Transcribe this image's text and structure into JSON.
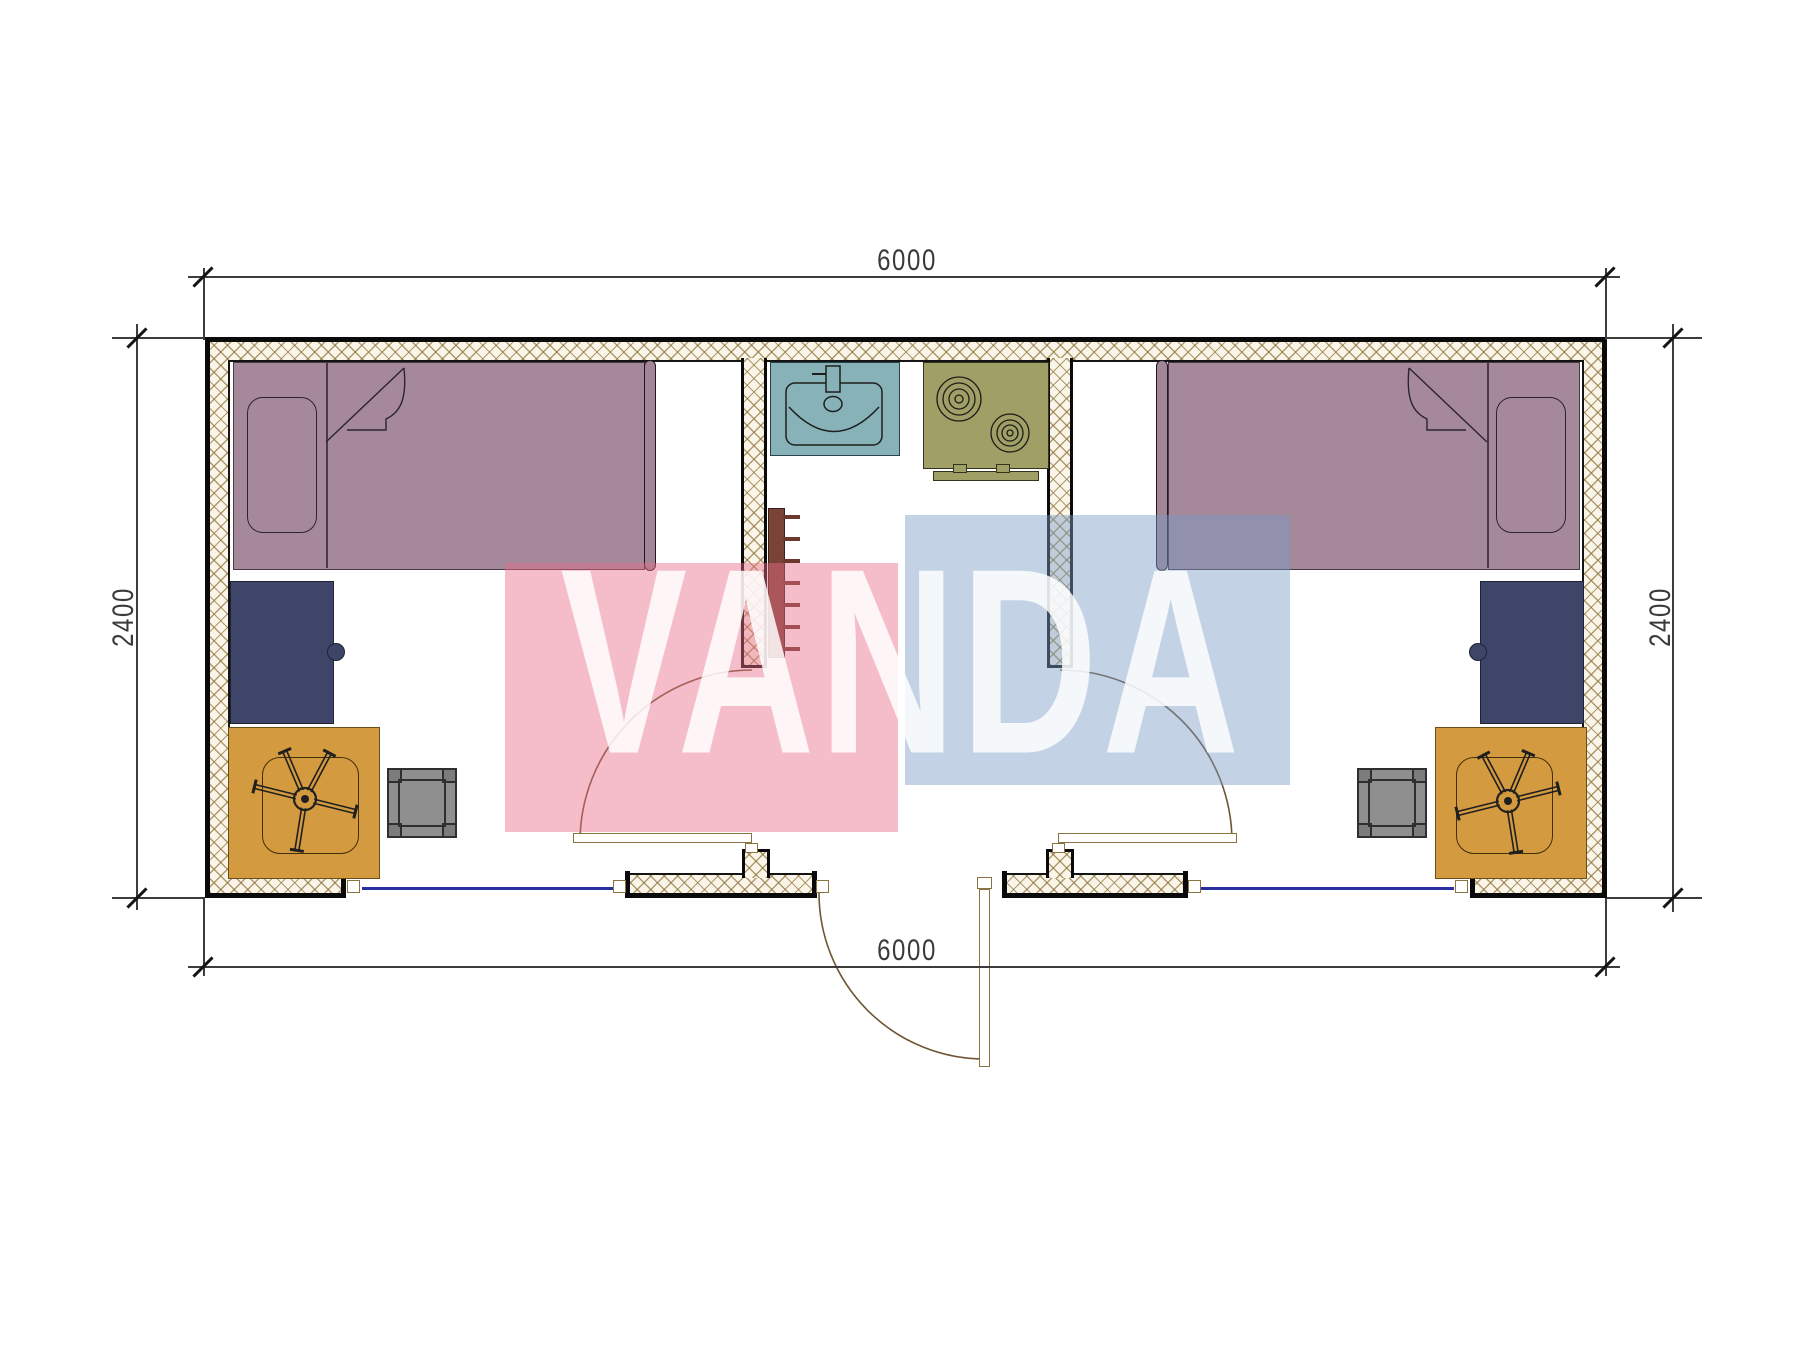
{
  "plan": {
    "type": "floor-plan",
    "overall_width_mm": "6000",
    "overall_depth_mm": "2400",
    "dimensions": {
      "top": "6000",
      "bottom": "6000",
      "left": "2400",
      "right": "2400"
    },
    "watermark": {
      "text": "VANDA",
      "pink_block": "#e96c87",
      "blue_block": "#7a9bc5",
      "letter_color": "#ffffff"
    },
    "colors": {
      "wall_fill": "#faf5e8",
      "wall_hatch": "#8c743a",
      "outline": "#0a0a0a",
      "bed": "#a5899b",
      "desk": "#3f4569",
      "chair_mat": "#d49a3f",
      "stool": "#8f8f8f",
      "sink": "#87b2b8",
      "stove": "#a0a066",
      "radiator": "#7a4338",
      "window_line": "#2830a0",
      "door_frame": "#8a7340",
      "door_arc": "#6e5533"
    },
    "rooms": {
      "left_bedroom": [
        "single-bed",
        "pillow",
        "blanket-fold",
        "desk",
        "office-chair",
        "chair-mat",
        "stool"
      ],
      "entry_kitchen": [
        "sink",
        "stove",
        "radiator",
        "entrance-door"
      ],
      "right_bedroom": [
        "single-bed",
        "pillow",
        "blanket-fold",
        "desk",
        "office-chair",
        "chair-mat",
        "stool"
      ]
    }
  }
}
